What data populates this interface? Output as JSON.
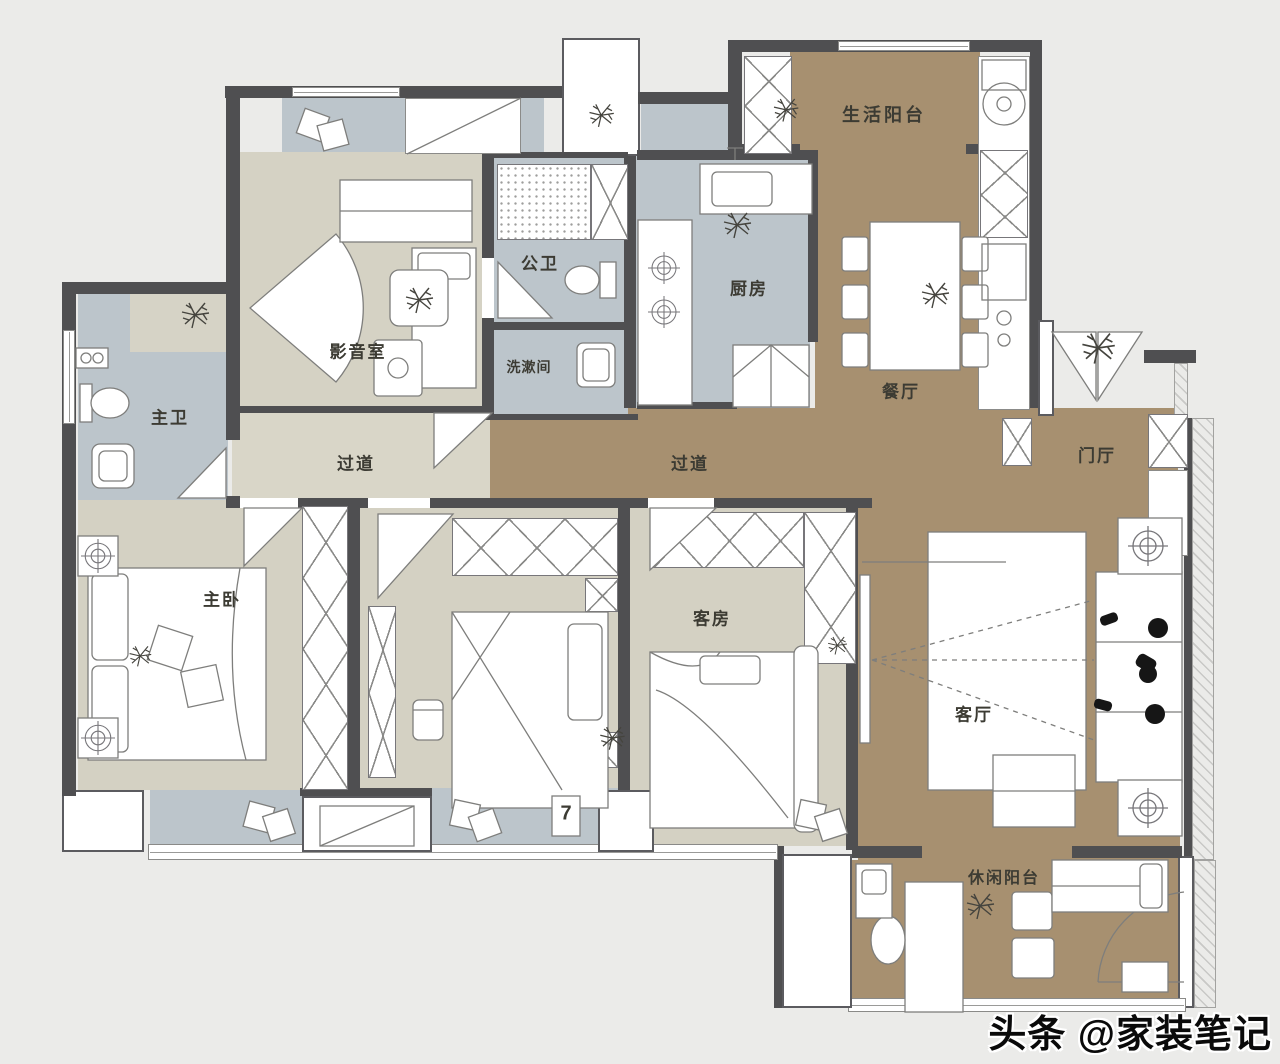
{
  "rooms": {
    "life_balcony": {
      "label": "生活阳台"
    },
    "kitchen": {
      "label": "厨房"
    },
    "public_bath": {
      "label": "公卫"
    },
    "washroom": {
      "label": "洗漱间"
    },
    "media_room": {
      "label": "影音室"
    },
    "master_bath": {
      "label": "主卫"
    },
    "corridor_west": {
      "label": "过道"
    },
    "corridor_east": {
      "label": "过道"
    },
    "dining": {
      "label": "餐厅"
    },
    "foyer": {
      "label": "门厅"
    },
    "master_bedroom": {
      "label": "主卧"
    },
    "guest_room": {
      "label": "客房"
    },
    "living_room": {
      "label": "客厅"
    },
    "leisure_balcony": {
      "label": "休闲阳台"
    }
  },
  "markers": {
    "number_7": "7"
  },
  "watermark": "头条 @家装笔记",
  "colors": {
    "background": "#ebebe9",
    "floor_tan": "#a79070",
    "floor_blue": "#bcc5cb",
    "floor_beige": "#d4d1c3",
    "floor_corridor": "#d9d6c8",
    "wall": "#4f4f51"
  }
}
